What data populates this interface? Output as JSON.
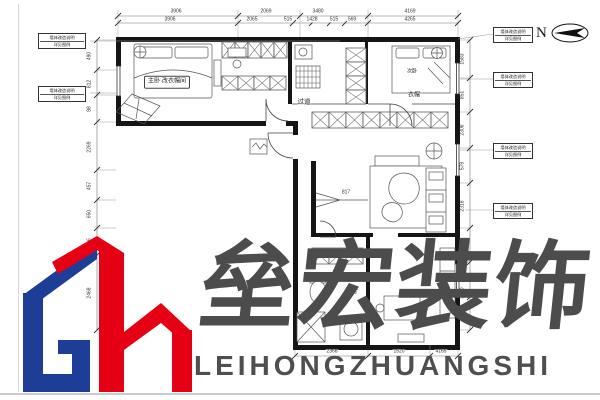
{
  "compass": {
    "label": "N"
  },
  "brand": {
    "cn": "垒宏装饰",
    "en": "LEIHONGZHUANGSHI",
    "logo_blue": "#1e3d96",
    "logo_red": "#e60013",
    "watermark_gray": "#4c4c4c"
  },
  "rooms": [
    {
      "label": "主卧·改衣帽间",
      "x": 167,
      "y": 82,
      "fs": 6,
      "boxed": true
    },
    {
      "label": "过道",
      "x": 304,
      "y": 102,
      "fs": 6.5,
      "boxed": false
    },
    {
      "label": "次卧",
      "x": 412,
      "y": 72,
      "fs": 5,
      "boxed": false
    },
    {
      "label": "衣帽",
      "x": 414,
      "y": 96,
      "fs": 6,
      "boxed": false
    },
    {
      "label": "餐厅",
      "x": 352,
      "y": 291,
      "fs": 6.5,
      "boxed": false
    }
  ],
  "dims": {
    "top1": [
      {
        "t": "3906",
        "x": 176
      },
      {
        "t": "2069",
        "x": 266
      },
      {
        "t": "3480",
        "x": 318
      },
      {
        "t": "4169",
        "x": 410
      }
    ],
    "top2": [
      {
        "t": "3906",
        "x": 170
      },
      {
        "t": "2065",
        "x": 252
      },
      {
        "t": "515",
        "x": 288
      },
      {
        "t": "1428",
        "x": 312
      },
      {
        "t": "515",
        "x": 334
      },
      {
        "t": "569",
        "x": 352
      },
      {
        "t": "4265",
        "x": 410
      }
    ],
    "left": [
      {
        "t": "490",
        "y": 56
      },
      {
        "t": "812",
        "y": 84
      },
      {
        "t": "98",
        "y": 109
      },
      {
        "t": "2269",
        "y": 147
      },
      {
        "t": "457",
        "y": 186
      },
      {
        "t": "650",
        "y": 214
      },
      {
        "t": "96",
        "y": 241
      },
      {
        "t": "2468",
        "y": 293
      }
    ],
    "right": [
      {
        "t": "1583",
        "y": 59
      },
      {
        "t": "851",
        "y": 95
      },
      {
        "t": "2308",
        "y": 130
      },
      {
        "t": "579",
        "y": 166
      },
      {
        "t": "2318",
        "y": 206
      },
      {
        "t": "298",
        "y": 245
      },
      {
        "t": "3060",
        "y": 293
      }
    ],
    "bottom": [
      {
        "t": "2368",
        "x": 332
      },
      {
        "t": "1520",
        "x": 399
      },
      {
        "t": "4165",
        "x": 441
      }
    ],
    "leaders": [
      {
        "t": "817",
        "x": 346,
        "y": 193
      }
    ]
  },
  "callouts": {
    "line1": "墙体改造说明",
    "line2": "详见图例",
    "boxes": [
      {
        "x": 38,
        "y": 33,
        "w": 48
      },
      {
        "x": 38,
        "y": 86,
        "w": 48
      },
      {
        "x": 493,
        "y": 27,
        "w": 40
      },
      {
        "x": 493,
        "y": 72,
        "w": 40
      },
      {
        "x": 493,
        "y": 143,
        "w": 40
      },
      {
        "x": 493,
        "y": 203,
        "w": 40
      }
    ]
  }
}
